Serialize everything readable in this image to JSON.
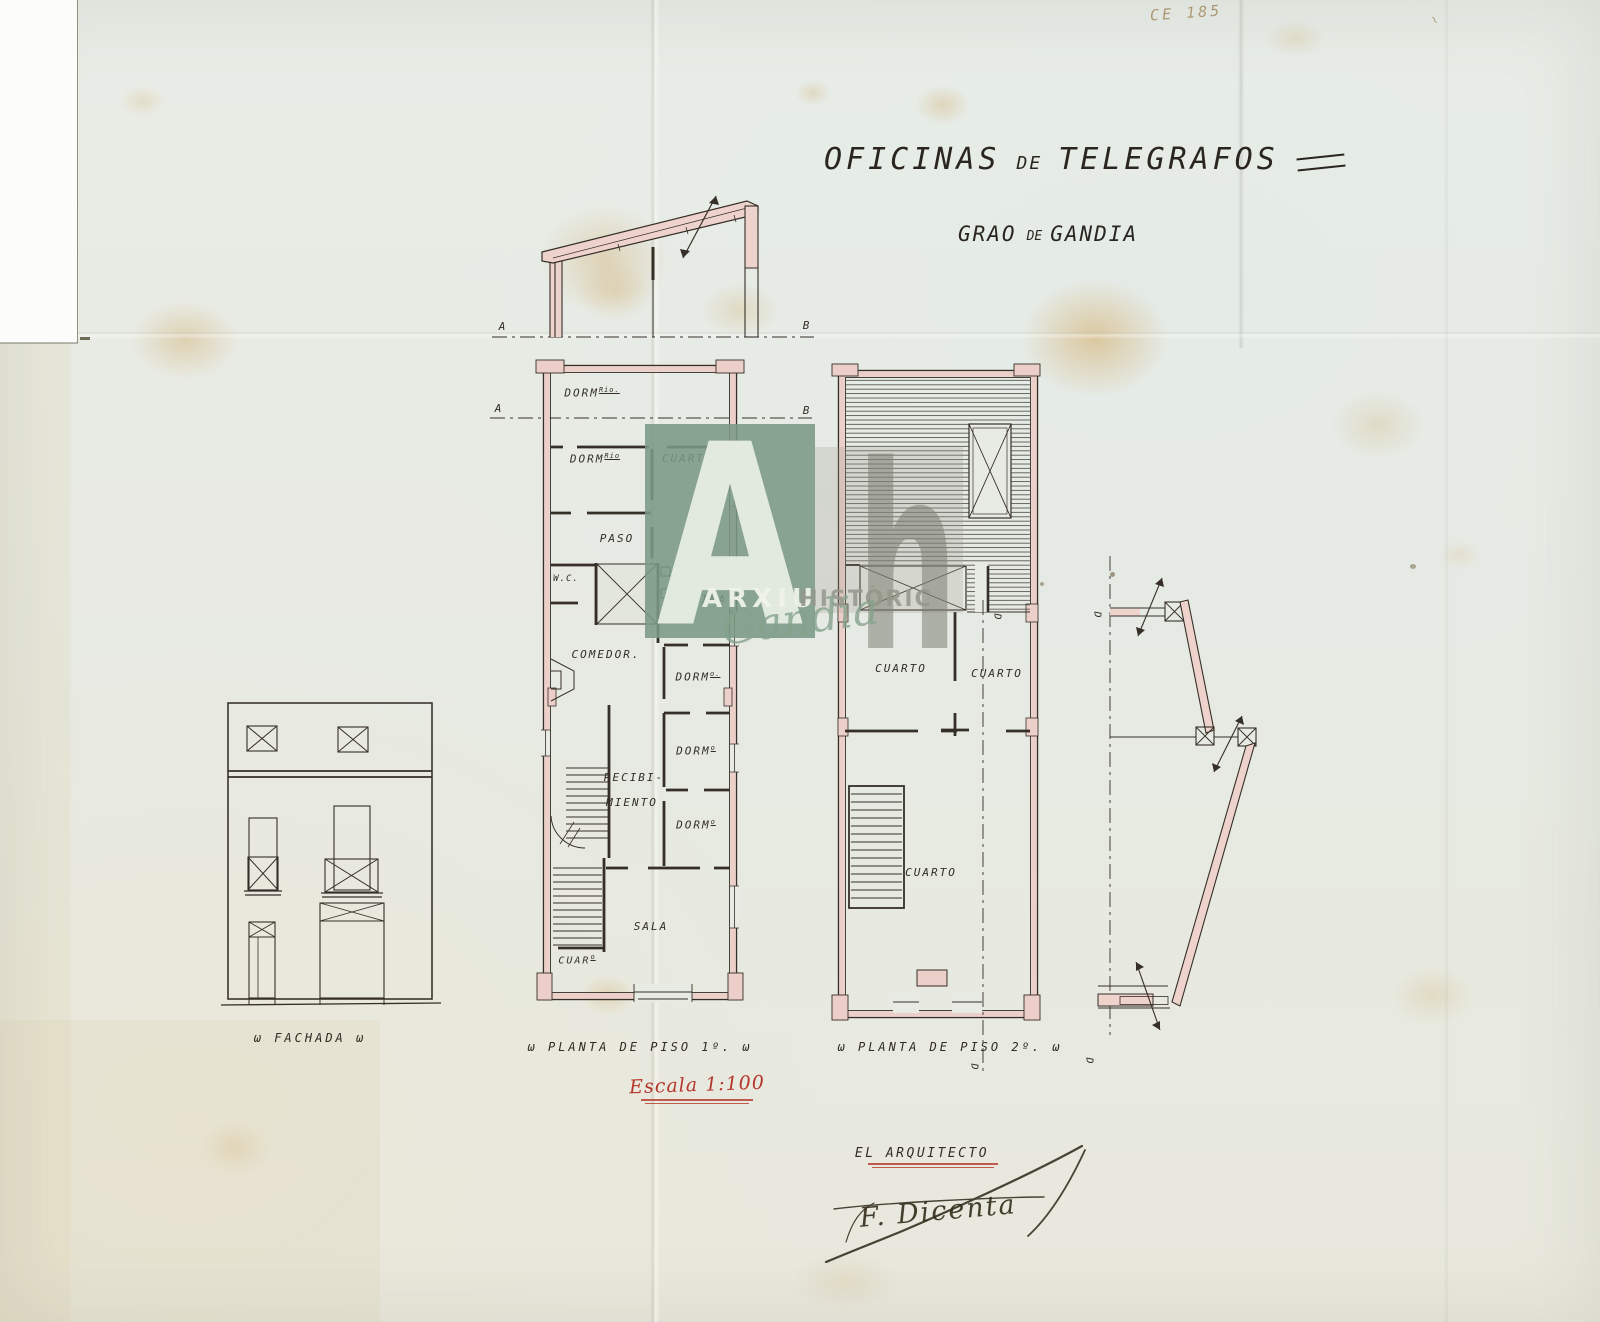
{
  "archive_note": "CE 185",
  "corner_mark": "~",
  "title": {
    "word1": "OFICINAS",
    "de": "DE",
    "word2": "TELEGRAFOS"
  },
  "subtitle": {
    "word1": "GRAO",
    "de": "DE",
    "word2": "GANDIA"
  },
  "watermark": {
    "letter_a": "A",
    "letter_h": "h",
    "arxiu": "ARXIU",
    "historic": "HISTÒRIC",
    "script": "Gandia"
  },
  "markers": {
    "a": "A",
    "b": "B",
    "d": "D"
  },
  "fachada": {
    "caption": "ω FACHADA ω"
  },
  "plan1": {
    "caption": "ω PLANTA DE PISO 1º. ω",
    "rooms": {
      "dorm1": {
        "t": "DORM",
        "s": "Rio."
      },
      "dorm2": {
        "t": "DORM",
        "s": "Rio"
      },
      "cuarto": "CUARTO.",
      "paso": "PASO",
      "wc": "W.C.",
      "cocina": "COCINA",
      "comedor": "COMEDOR.",
      "dorm3": {
        "t": "DORM",
        "s": "o."
      },
      "dorm4": {
        "t": "DORM",
        "s": "o"
      },
      "recibidor_line1": "RECIBI-",
      "recibidor_line2": "MIENTO",
      "dorm5": {
        "t": "DORM",
        "s": "o"
      },
      "sala": "SALA",
      "cuar": {
        "t": "CUAR",
        "s": "o"
      }
    }
  },
  "plan2": {
    "caption": "ω PLANTA DE PISO 2º. ω",
    "rooms": {
      "cuarto_left": "CUARTO",
      "cuarto_right": "CUARTO",
      "cuarto_big": "CUARTO"
    }
  },
  "scale_note": "Escala 1:100",
  "architect": {
    "label": "EL ARQUITECTO",
    "signature": "F. Dicenta"
  },
  "colors": {
    "paper": "#e8ebe3",
    "ink": "#352f28",
    "wall_pink": "#eccfc8",
    "accent_red": "#b5362c",
    "watermark_green": "#7b988a",
    "stain_amber": "#c99a48"
  }
}
